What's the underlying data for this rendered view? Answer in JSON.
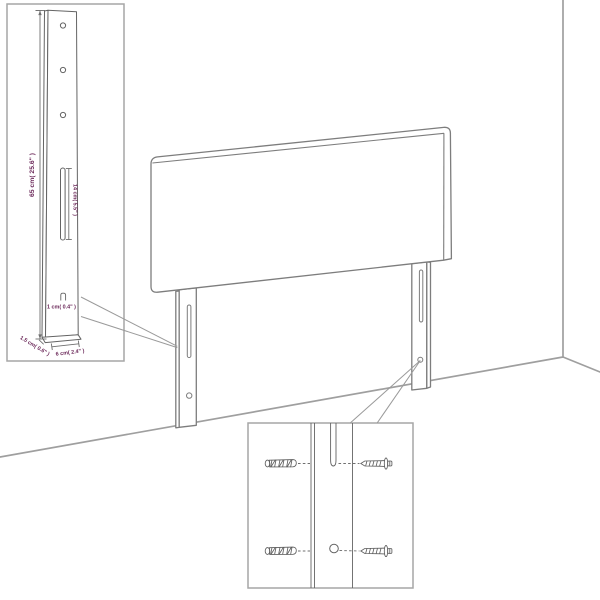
{
  "diagram": {
    "subject": "headboard wall-mounting dimension diagram",
    "insets": {
      "left": {
        "name": "leg dimension detail",
        "mounting_holes": 3,
        "features": [
          "keyhole-slot",
          "hook"
        ]
      },
      "right": {
        "name": "wall mounting hardware detail",
        "rows": 2,
        "hardware": [
          "wall-plug",
          "screw"
        ]
      }
    }
  },
  "dimension_labels": {
    "leg_height": "65 cm( 25.6\" )",
    "slot_length": "14 cm( 5.5\" )",
    "hook_size": "1 cm( 0.4\" )",
    "leg_depth": "1.5 cm( 0.6\" )",
    "leg_width": "6 cm( 2.4\" )"
  },
  "colors": {
    "background": "#ffffff",
    "drawing_line": "#7d7d7d",
    "detail_line": "#646464",
    "inset_border": "#a6a6a6",
    "room_line": "#9f9f9f",
    "dimension_text": "#6b2859"
  }
}
